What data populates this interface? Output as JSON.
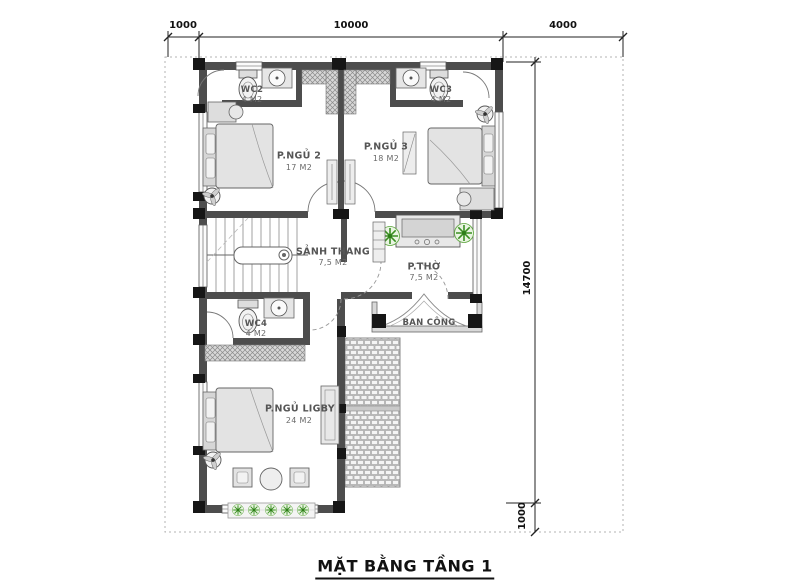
{
  "drawing": {
    "title": "MẶT BẰNG TẦNG 1"
  },
  "dimensions": {
    "top": {
      "d1": "1000",
      "d2": "10000",
      "d3": "4000"
    },
    "right": {
      "d1": "14700",
      "d2": "1000"
    }
  },
  "rooms": {
    "wc2": {
      "name": "WC2",
      "area": "4 M2"
    },
    "wc3": {
      "name": "WC3",
      "area": "4 M2"
    },
    "bedroom2": {
      "name": "P.NGỦ 2",
      "area": "17 M2"
    },
    "bedroom3": {
      "name": "P.NGỦ 3",
      "area": "18 M2"
    },
    "stair_hall": {
      "name": "SẢNH THANG",
      "area": "7,5 M2"
    },
    "worship": {
      "name": "P.THỜ",
      "area": "7,5 M2"
    },
    "wc4": {
      "name": "WC4",
      "area": "4 M2"
    },
    "master": {
      "name": "P.NGỦ LIGBY",
      "area": "24 M2"
    },
    "balcony": {
      "name": "BAN CÔNG"
    }
  },
  "colors": {
    "wall": "#4d4d4d",
    "column": "#161616",
    "plant_green": "#3a8f22",
    "linework": "#222222",
    "boundary": "#b3b3b3"
  }
}
